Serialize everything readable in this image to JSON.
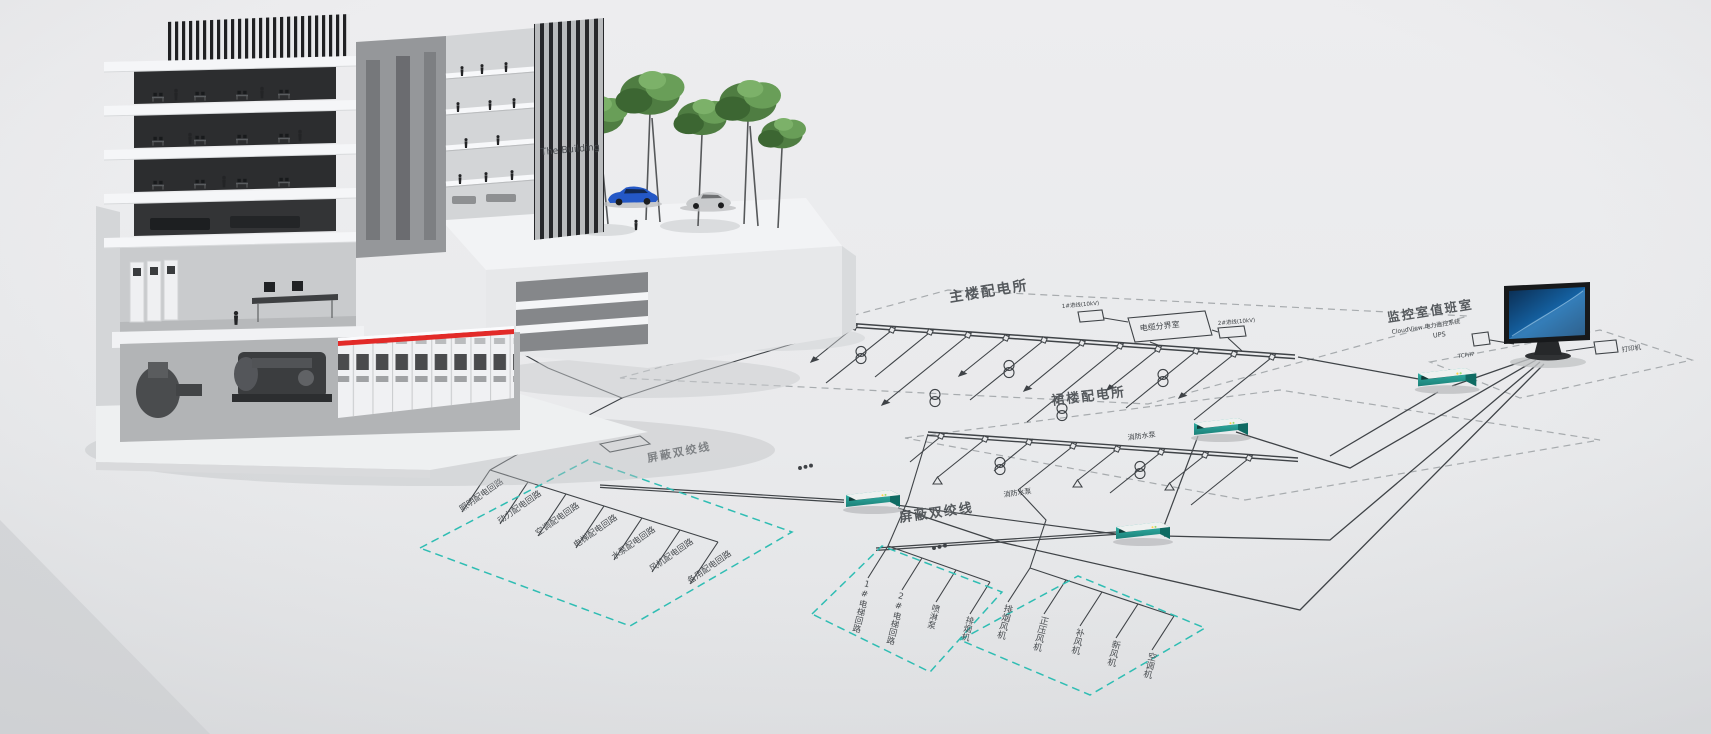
{
  "building": {
    "sign": "The Building"
  },
  "diagram": {
    "areas": {
      "main_substation": "主楼配电所",
      "podium_substation": "裙楼配电所",
      "cable_room": "电缆分界室",
      "monitor_room": "监控室值班室",
      "monitor_room_subtitle": "CloudView 电力监控系统"
    },
    "incoming": [
      "1#进线(10kV)",
      "2#进线(10kV)"
    ],
    "shielded_twisted_pair": "屏蔽双绞线",
    "fire_pump": "消防水泵",
    "left_circuits": [
      "照明配电回路",
      "动力配电回路",
      "空调配电回路",
      "电梯配电回路",
      "水泵配电回路",
      "风机配电回路",
      "备用配电回路"
    ],
    "mid_circuits": [
      "1#电梯回路",
      "2#电梯回路",
      "喷淋泵",
      "排烟机"
    ],
    "fan_circuits": [
      "排烟风机",
      "正压风机",
      "补风机",
      "新风机",
      "空调机"
    ],
    "peripherals": {
      "ups": "UPS",
      "printer": "打印机",
      "protocol": "TCP/IP"
    }
  },
  "colors": {
    "background": "#e9eaec",
    "diagram_line": "#3f4347",
    "dashed_boundary": "#a7abae",
    "accent_teal": "#2fbdb3",
    "gateway_teal": "#27a79e",
    "switchgear_red_stripe": "#e22a28",
    "monitor_screen_blue": "#1565a8",
    "tree_green": "#4f7d42"
  }
}
